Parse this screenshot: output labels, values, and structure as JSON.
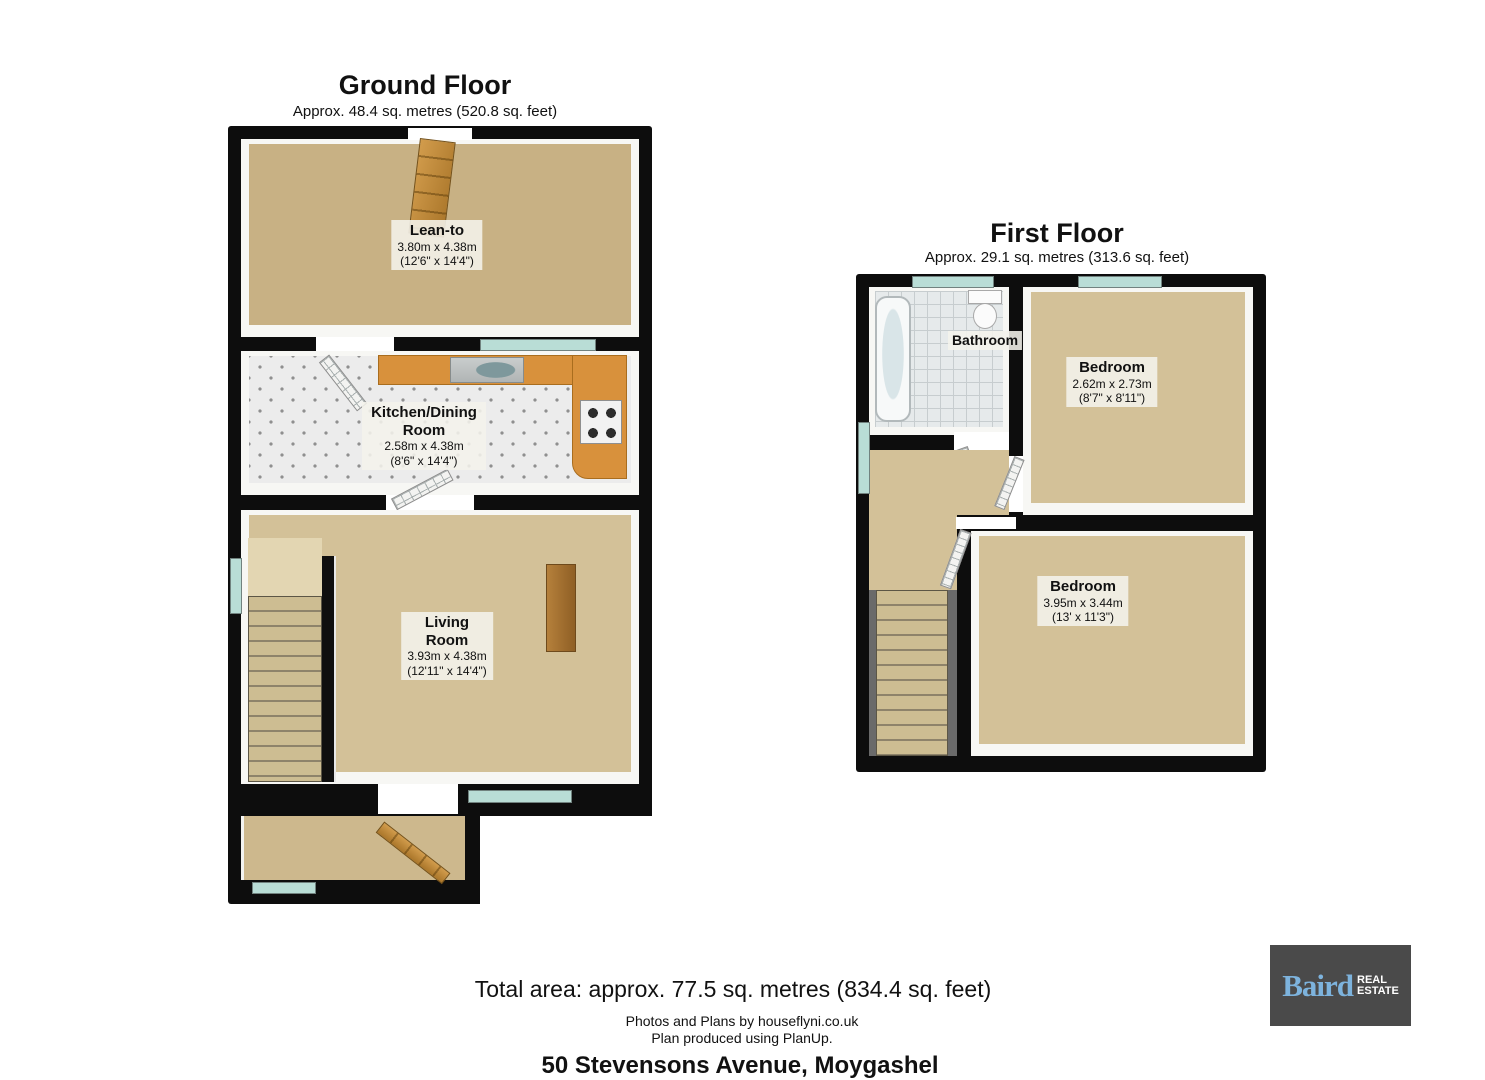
{
  "colors": {
    "wall": "#0d0d0d",
    "floor_tan": "#c8b184",
    "floor_beige": "#d3c198",
    "floor_hall": "#cdb88d",
    "kitchen_floor": "#ececec",
    "counter": "#d8913c",
    "window_glass": "#b9ddd6",
    "logo_bg": "#4a4a4a",
    "logo_brand": "#7db3dd"
  },
  "ground_floor": {
    "title": "Ground Floor",
    "subtitle": "Approx. 48.4 sq. metres (520.8 sq. feet)",
    "lean_to": {
      "name": "Lean-to",
      "dims_m": "3.80m x 4.38m",
      "dims_ft": "(12'6\" x 14'4\")"
    },
    "kitchen": {
      "name": "Kitchen/Dining Room",
      "dims_m": "2.58m x 4.38m",
      "dims_ft": "(8'6\" x 14'4\")"
    },
    "living": {
      "name": "Living Room",
      "dims_m": "3.93m x 4.38m",
      "dims_ft": "(12'11\" x 14'4\")"
    }
  },
  "first_floor": {
    "title": "First Floor",
    "subtitle": "Approx. 29.1 sq. metres (313.6 sq. feet)",
    "bathroom": {
      "name": "Bathroom"
    },
    "bedroom_small": {
      "name": "Bedroom",
      "dims_m": "2.62m x 2.73m",
      "dims_ft": "(8'7\" x 8'11\")"
    },
    "bedroom_large": {
      "name": "Bedroom",
      "dims_m": "3.95m x 3.44m",
      "dims_ft": "(13' x 11'3\")"
    }
  },
  "footer": {
    "total_area": "Total area: approx. 77.5 sq. metres (834.4 sq. feet)",
    "credit_photos": "Photos and Plans by houseflyni.co.uk",
    "credit_planup": "Plan produced using PlanUp.",
    "address": "50 Stevensons Avenue, Moygashel"
  },
  "logo": {
    "brand": "Baird",
    "tag_line1": "REAL",
    "tag_line2": "ESTATE"
  }
}
